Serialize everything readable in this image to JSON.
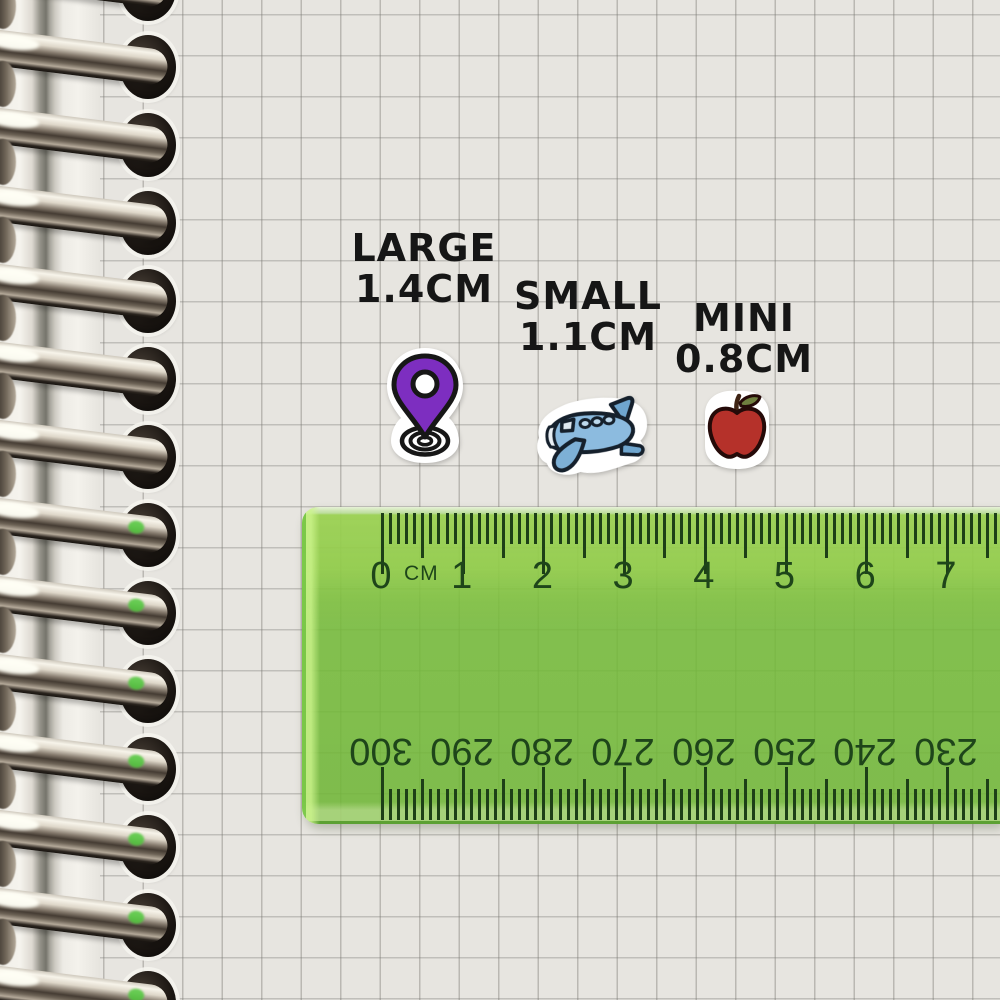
{
  "notebook": {
    "ring_count": 14
  },
  "items": [
    {
      "id": "large",
      "label": "LARGE",
      "size": "1.4CM",
      "sticker": "location-pin"
    },
    {
      "id": "small",
      "label": "SMALL",
      "size": "1.1CM",
      "sticker": "airplane"
    },
    {
      "id": "mini",
      "label": "MINI",
      "size": "0.8CM",
      "sticker": "apple"
    }
  ],
  "ruler": {
    "unit_label": "CM",
    "top_scale_numbers": [
      "0",
      "1",
      "2",
      "3",
      "4",
      "5",
      "6",
      "7"
    ],
    "bottom_scale_numbers": [
      "300",
      "290",
      "280",
      "270",
      "260",
      "250",
      "240",
      "230"
    ],
    "ticks_per_cm": 10
  },
  "colors": {
    "paper": "#e7e5e0",
    "grid_line": "#b2b0aa",
    "ruler_green": "#7cbf4a",
    "ruler_ink": "#1e451a",
    "label_ink": "#161616",
    "pin_purple": "#7d2ec0",
    "plane_blue": "#8cbbdf",
    "apple_red": "#b5312a"
  }
}
